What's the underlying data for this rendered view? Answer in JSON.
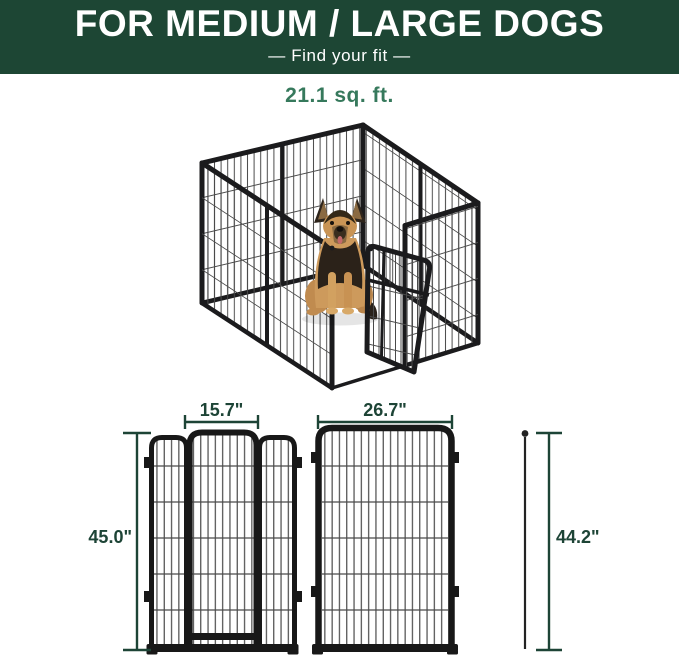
{
  "header": {
    "title": "FOR MEDIUM / LARGE DOGS",
    "subtitle": "—  Find your fit  —"
  },
  "area_label": "21.1 sq. ft.",
  "colors": {
    "banner_green": "#1d4634",
    "area_label_green": "#36795c",
    "dimension_green": "#1d4436",
    "frame_black": "#181818",
    "wire_gray": "#4a4a4a"
  },
  "diagrams": {
    "door_panel": {
      "width_label": "15.7\"",
      "height_label": "45.0\""
    },
    "regular_panel": {
      "width_label": "26.7\"",
      "height_label": "44.2\""
    }
  }
}
